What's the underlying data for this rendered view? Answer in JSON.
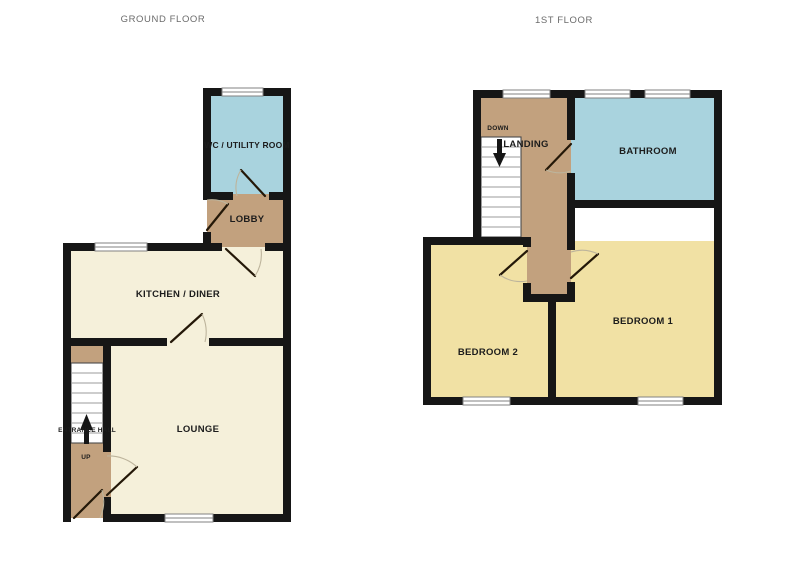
{
  "palette": {
    "background": "#ffffff",
    "wall": "#161616",
    "room_cream": "#f5f0da",
    "room_tan": "#c2a17e",
    "room_blue": "#a9d3de",
    "room_yellow": "#f1e1a4",
    "title_text": "#6b6b6b",
    "label_text": "#1c1c1c"
  },
  "titles": {
    "ground_floor": "GROUND FLOOR",
    "first_floor": "1ST FLOOR"
  },
  "ground_floor": {
    "rooms": {
      "wc_utility": {
        "label": "WC / UTILITY ROOM"
      },
      "lobby": {
        "label": "LOBBY"
      },
      "kitchen_diner": {
        "label": "KITCHEN / DINER"
      },
      "lounge": {
        "label": "LOUNGE"
      },
      "entrance_hall": {
        "label": "ENTRANCE HALL",
        "stairs_direction": "UP"
      }
    }
  },
  "first_floor": {
    "rooms": {
      "landing": {
        "label": "LANDING",
        "stairs_direction": "DOWN"
      },
      "bathroom": {
        "label": "BATHROOM"
      },
      "bedroom_1": {
        "label": "BEDROOM 1"
      },
      "bedroom_2": {
        "label": "BEDROOM 2"
      }
    }
  }
}
